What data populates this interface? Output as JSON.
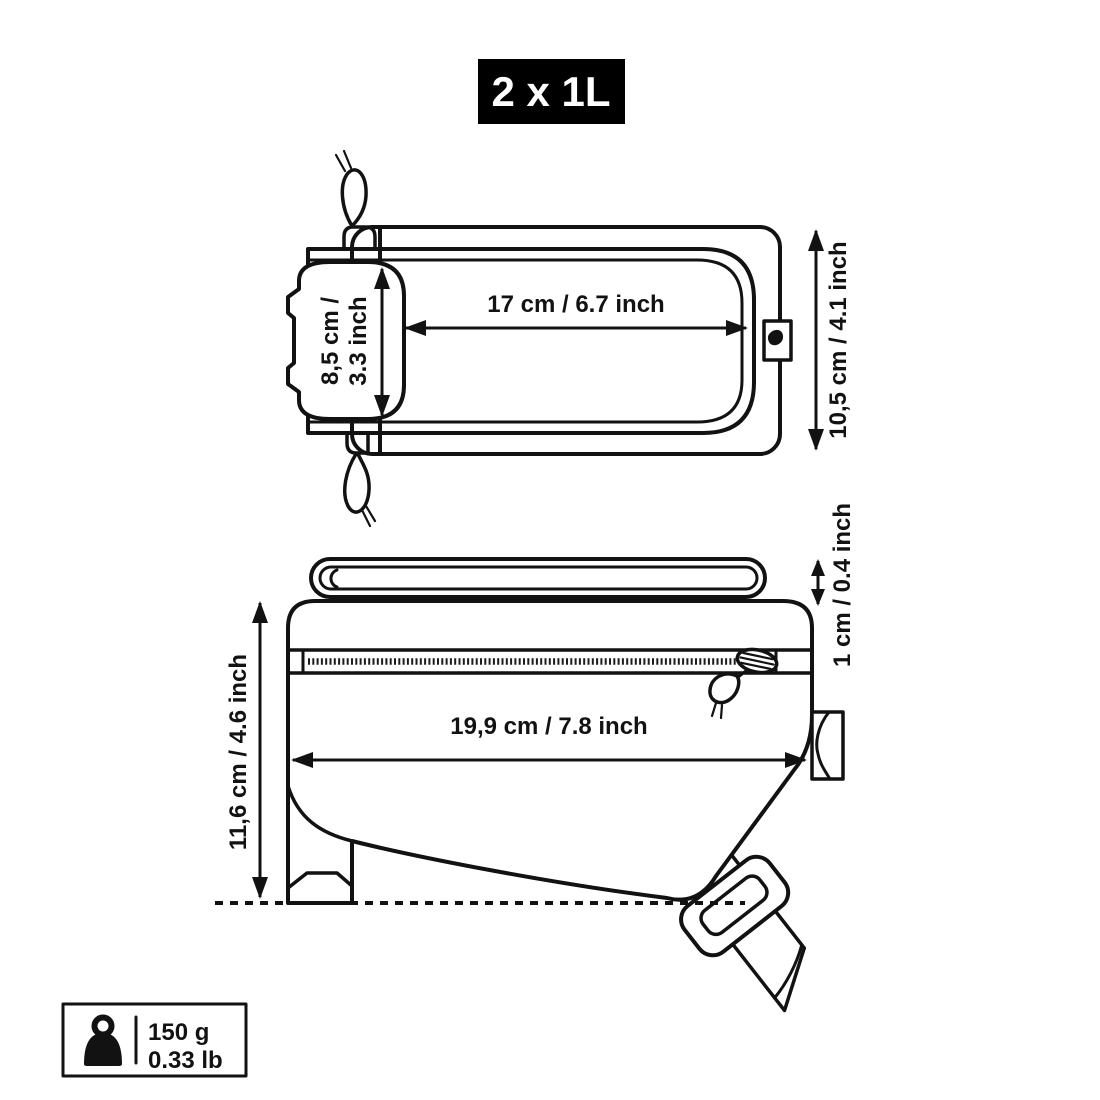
{
  "badge": {
    "label": "2 x 1L"
  },
  "top_view": {
    "width_dimension": {
      "label": "17 cm / 6.7 inch"
    },
    "flap_height_dimension": {
      "label_line1": "8,5 cm /",
      "label_line2": "3.3 inch"
    },
    "height_dimension": {
      "label": "10,5 cm / 4.1 inch"
    }
  },
  "side_view": {
    "strap_thickness_dimension": {
      "label": "1 cm / 0.4 inch"
    },
    "length_dimension": {
      "label": "19,9 cm / 7.8 inch"
    },
    "height_dimension": {
      "label": "11,6 cm / 4.6 inch"
    }
  },
  "weight": {
    "grams": "150 g",
    "pounds": "0.33 lb",
    "icon": "weight-icon"
  },
  "colors": {
    "ink": "#121212",
    "background": "#ffffff",
    "badge_background": "#000000",
    "badge_text": "#ffffff"
  }
}
